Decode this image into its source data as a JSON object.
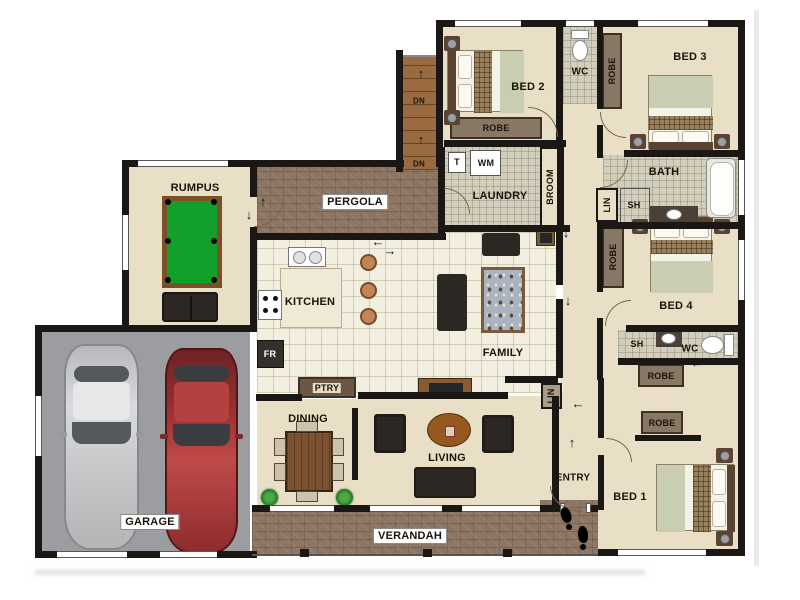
{
  "labels": {
    "rumpus": "RUMPUS",
    "pergola": "PERGOLA",
    "kitchen": "KITCHEN",
    "family": "FAMILY",
    "laundry": "LAUNDRY",
    "broom": "BROOM",
    "dining": "DINING",
    "living": "LIVING",
    "entry": "ENTRY",
    "verandah": "VERANDAH",
    "garage": "GARAGE",
    "bed1": "BED 1",
    "bed2": "BED 2",
    "bed3": "BED 3",
    "bed4": "BED 4",
    "bath": "BATH",
    "wc_top": "WC",
    "wc_ensuite": "WC",
    "sh_bath": "SH",
    "sh_ensuite": "SH",
    "lin_bath": "LIN",
    "lin_hall": "LIN",
    "robe_bed2": "ROBE",
    "robe_bed3": "ROBE",
    "robe_bed4": "ROBE",
    "robe_hall": "ROBE",
    "robe_bed1": "ROBE",
    "ptry": "PTRY",
    "fridge": "FR",
    "laundry_tub": "T",
    "washer": "WM",
    "dn_upper": "DN",
    "dn_lower": "DN"
  },
  "icons": {
    "arrow_up": "↑",
    "arrow_down": "↓",
    "arrow_left": "←",
    "arrow_right": "→"
  },
  "colors": {
    "wall": "#1b1714",
    "carpet": "#e9dfc6",
    "tile": "#f2efe1",
    "wet": "#d2cebc",
    "brick": "#8c7562",
    "garage": "#9c9da0",
    "closet": "#887765",
    "wood": "#9a6b41",
    "pool_green": "#12a02b",
    "pool_rail": "#7b5029",
    "sofa": "#2d2723",
    "duvet": "#c9cdb2",
    "plaid": "#97805c",
    "car_silver": "#c7c8ca",
    "car_red": "#9c3132",
    "label": "#1c130a"
  }
}
